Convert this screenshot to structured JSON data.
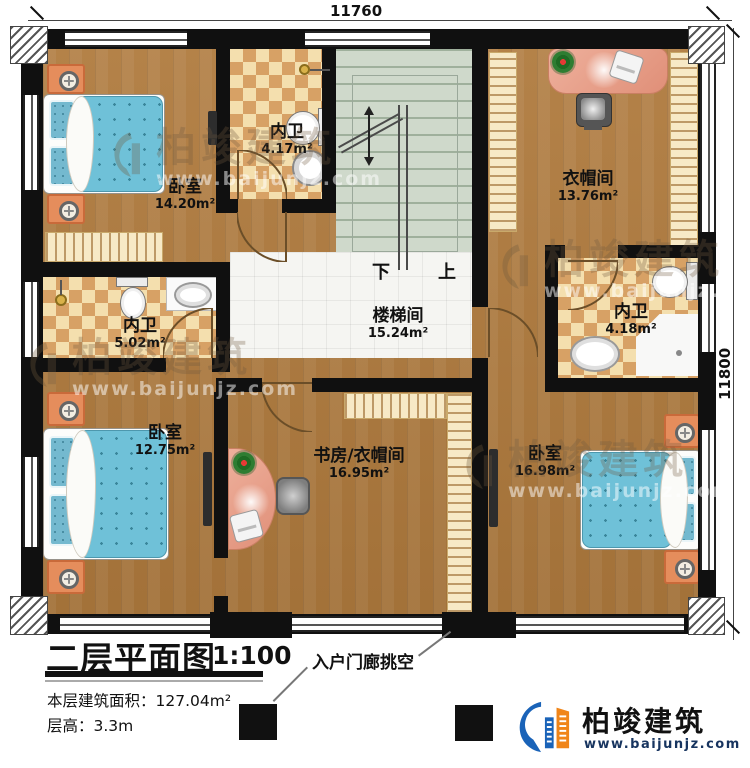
{
  "dimensions": {
    "top": "11760",
    "right": "11800"
  },
  "rooms": [
    {
      "name": "卧室",
      "area": "14.20m²"
    },
    {
      "name": "内卫",
      "area": "4.17m²"
    },
    {
      "name": "衣帽间",
      "area": "13.76m²"
    },
    {
      "name": "内卫",
      "area": "5.02m²"
    },
    {
      "name": "楼梯间",
      "area": "15.24m²"
    },
    {
      "name": "内卫",
      "area": "4.18m²"
    },
    {
      "name": "卧室",
      "area": "12.75m²"
    },
    {
      "name": "书房/衣帽间",
      "area": "16.95m²"
    },
    {
      "name": "卧室",
      "area": "16.98m²"
    }
  ],
  "stairs": {
    "down_label": "下",
    "up_label": "上"
  },
  "annotations": {
    "porch": "入户门廊挑空"
  },
  "title_block": {
    "title": "二层平面图",
    "scale": "1:100",
    "floor_area": "本层建筑面积：127.04m²",
    "floor_height": "层高：3.3m"
  },
  "brand": {
    "name": "柏竣建筑",
    "website": "www.baijunjz.com"
  },
  "watermark": {
    "name": "柏竣建筑",
    "website": "www.baijunjz.com"
  },
  "colors": {
    "wall": "#101010",
    "wood": "#af7a3d",
    "tile_light": "#f4dfae",
    "tile_dark": "#d7a165",
    "stair": "#cfd9cb",
    "bed_blue": "#6fc1d8",
    "nightstand_orange": "#e58d5c",
    "desk_pink": "#e8a18b",
    "brand_blue": "#1a63b8",
    "brand_orange": "#f08519"
  }
}
